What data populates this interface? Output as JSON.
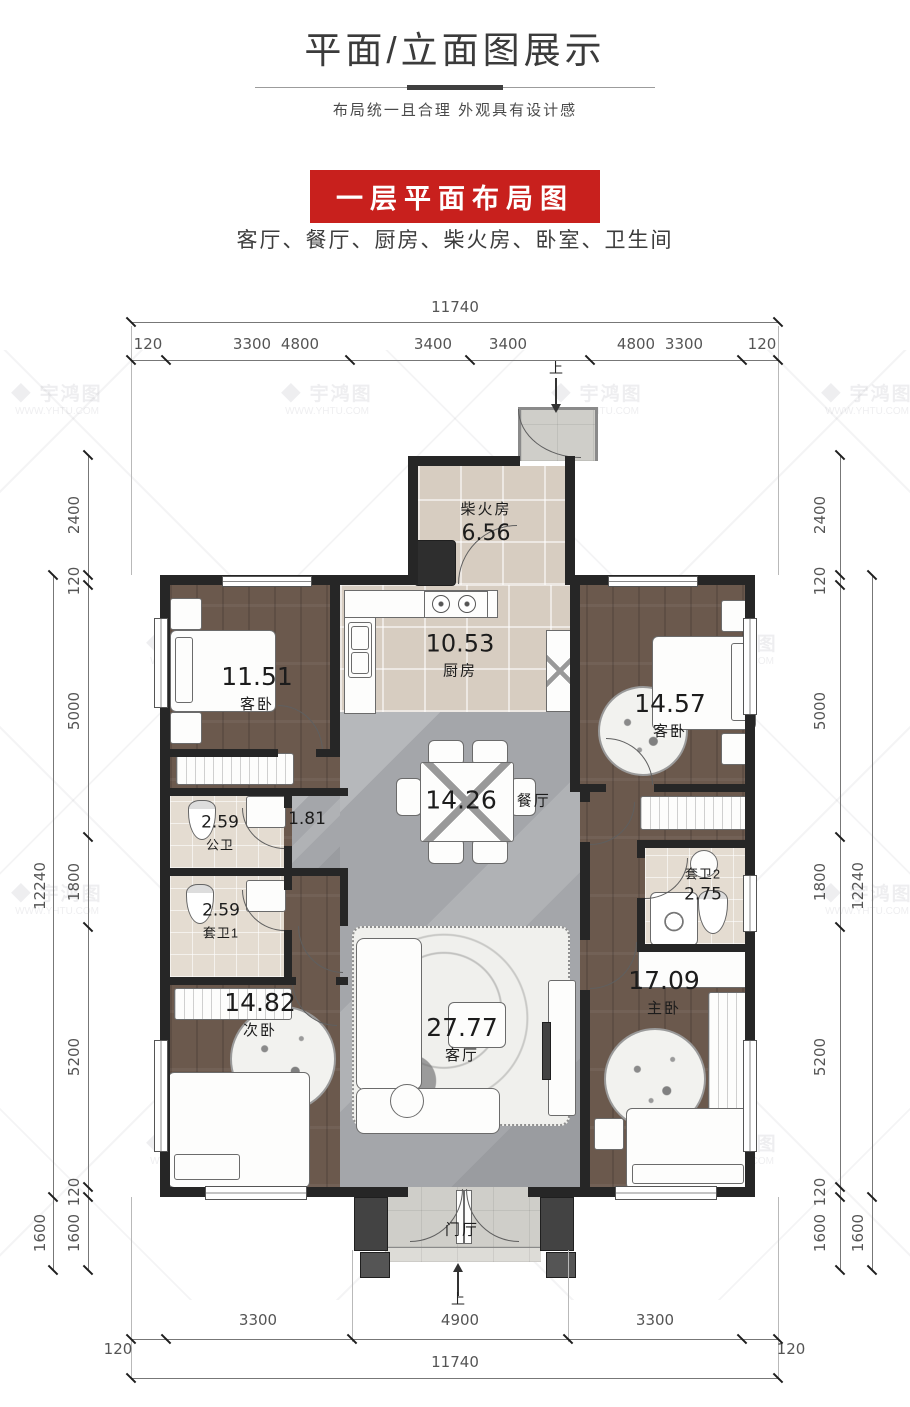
{
  "header": {
    "title": "平面/立面图展示",
    "subtitle": "布局统一且合理 外观具有设计感",
    "badge": "一层平面布局图",
    "room_list": "客厅、餐厅、厨房、柴火房、卧室、卫生间"
  },
  "watermark": {
    "logo": "◆",
    "brand": "宇鸿图",
    "url": "WWW.YHTU.COM"
  },
  "plan": {
    "entry_top": "上",
    "entry_bottom": "上",
    "rooms": [
      {
        "name": "柴火房",
        "area": "6.56"
      },
      {
        "name": "厨房",
        "area": "10.53"
      },
      {
        "name": "客卧",
        "area": "11.51"
      },
      {
        "name": "客卧",
        "area": "14.57"
      },
      {
        "name": "餐厅",
        "area": "14.26"
      },
      {
        "name": "",
        "area": "1.81"
      },
      {
        "name": "公卫",
        "area": "2.59"
      },
      {
        "name": "套卫1",
        "area": "2.59"
      },
      {
        "name": "套卫2",
        "area": "2.75"
      },
      {
        "name": "次卧",
        "area": "14.82"
      },
      {
        "name": "主卧",
        "area": "17.09"
      },
      {
        "name": "客厅",
        "area": "27.77"
      },
      {
        "name": "门厅",
        "area": ""
      }
    ]
  },
  "dimensions": {
    "top": {
      "total": "11740",
      "chain": [
        "120",
        "3300",
        "4800",
        "3400",
        "3400",
        "4800",
        "3300",
        "120"
      ]
    },
    "bottom": {
      "total": "11740",
      "chain": [
        "120",
        "3300",
        "4900",
        "3300",
        "120"
      ]
    },
    "left": {
      "total": "12240",
      "chain": [
        "2400",
        "120",
        "5000",
        "1800",
        "5200",
        "120",
        "1600"
      ],
      "outer_bottom": "1600"
    },
    "right": {
      "total": "12240",
      "chain": [
        "2400",
        "120",
        "5000",
        "1800",
        "5200",
        "120",
        "1600"
      ],
      "outer_bottom": "1600"
    }
  },
  "colors": {
    "accent_red": "#c8201d",
    "wall": "#262626",
    "wood_floor": "#6b594d",
    "tile_floor": "#d7cdc1",
    "marble_floor": "#a4a6aa",
    "bath_floor": "#e4dcd1"
  }
}
